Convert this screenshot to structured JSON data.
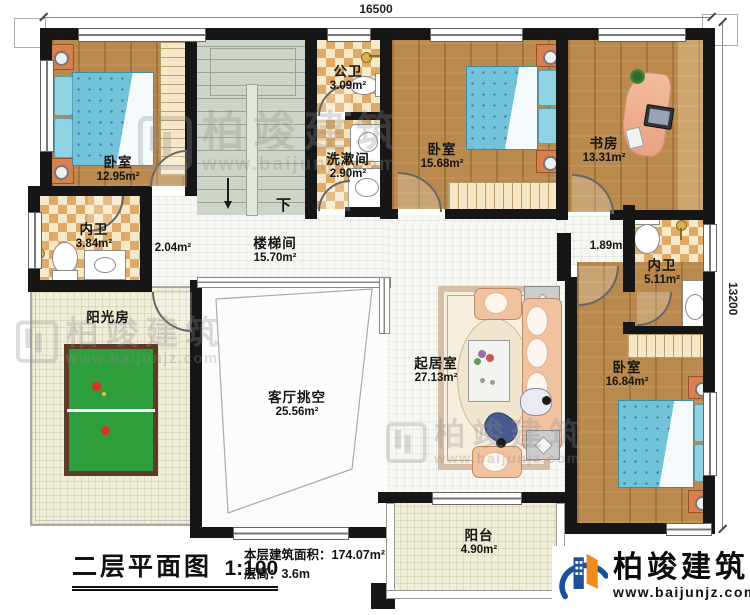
{
  "dimensions": {
    "top": "16500",
    "right": "13200"
  },
  "rooms": [
    {
      "name": "卧室",
      "area": "12.95m²"
    },
    {
      "name": "楼梯间",
      "area": "15.70m²"
    },
    {
      "name": "公卫",
      "area": "3.09m²"
    },
    {
      "name": "洗漱间",
      "area": "2.90m²"
    },
    {
      "name": "卧室",
      "area": "15.68m²"
    },
    {
      "name": "书房",
      "area": "13.31m²"
    },
    {
      "name": "内卫",
      "area": "3.84m²"
    },
    {
      "name": "",
      "area": "2.04m²"
    },
    {
      "name": "",
      "area": "1.89m²"
    },
    {
      "name": "内卫",
      "area": "5.11m²"
    },
    {
      "name": "阳光房",
      "area": ""
    },
    {
      "name": "客厅挑空",
      "area": "25.56m²"
    },
    {
      "name": "起居室",
      "area": "27.13m²"
    },
    {
      "name": "卧室",
      "area": "16.84m²"
    },
    {
      "name": "阳台",
      "area": "4.90m²"
    }
  ],
  "annotations": {
    "down": "下"
  },
  "title_block": {
    "title": "二层平面图",
    "scale": "1:100",
    "area_note": "本层建筑面积：174.07m²",
    "floor_height": "层高：3.6m"
  },
  "brand": {
    "name": "柏竣建筑",
    "site": "www.baijunjz.com"
  },
  "watermark": {
    "name": "柏竣建筑",
    "site": "www.baijunjz.com"
  },
  "colors": {
    "wall": "#161616",
    "wood": "#b9894e",
    "tile_check": "#dfaa67",
    "stair": "#ccd5c8",
    "bed_blue": "#72c3da",
    "table_green": "#2f9e3c",
    "logo_blue": "#1c4f9c",
    "logo_orange": "#f08a1d"
  }
}
